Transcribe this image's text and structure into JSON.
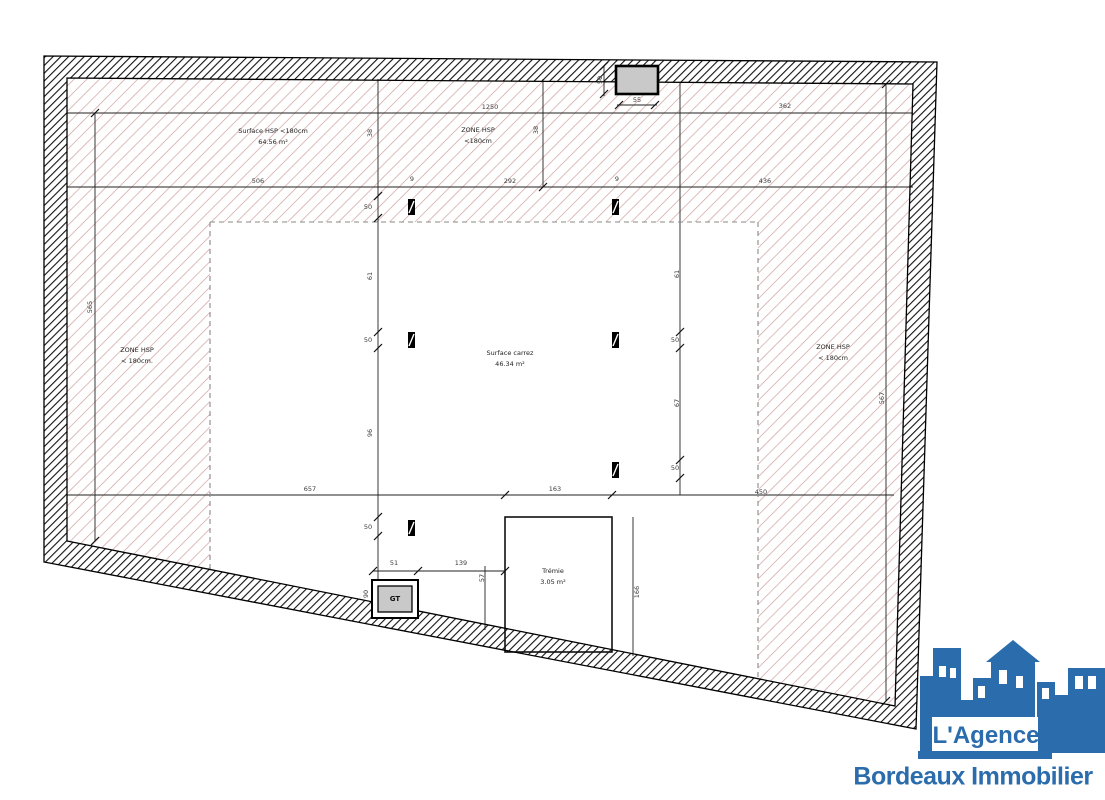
{
  "plan": {
    "labels": {
      "surface_hsp": {
        "line1": "Surface HSP <180cm",
        "line2": "64.56 m²"
      },
      "zone_top": {
        "line1": "ZONE HSP",
        "line2": "<180cm"
      },
      "zone_left": {
        "line1": "ZONE HSP",
        "line2": "< 180cm."
      },
      "zone_right": {
        "line1": "ZONE HSP",
        "line2": "< 180cm"
      },
      "surface_carrez": {
        "line1": "Surface carrez",
        "line2": "46.34 m²"
      },
      "tremie": {
        "line1": "Trémie",
        "line2": "3.05 m²"
      },
      "gt": "GT"
    },
    "dimensions": [
      {
        "value": "1250",
        "x": 490,
        "y": 107
      },
      {
        "value": "362",
        "x": 785,
        "y": 106
      },
      {
        "value": "55",
        "x": 637,
        "y": 100
      },
      {
        "value": "50",
        "x": 600,
        "y": 80,
        "rot": -90
      },
      {
        "value": "506",
        "x": 258,
        "y": 181
      },
      {
        "value": "292",
        "x": 510,
        "y": 181
      },
      {
        "value": "436",
        "x": 765,
        "y": 181
      },
      {
        "value": "9",
        "x": 412,
        "y": 179
      },
      {
        "value": "9",
        "x": 617,
        "y": 179
      },
      {
        "value": "38",
        "x": 370,
        "y": 133,
        "rot": -90
      },
      {
        "value": "38",
        "x": 536,
        "y": 130,
        "rot": -90
      },
      {
        "value": "50",
        "x": 368,
        "y": 207
      },
      {
        "value": "61",
        "x": 370,
        "y": 276,
        "rot": -90
      },
      {
        "value": "50",
        "x": 368,
        "y": 340
      },
      {
        "value": "96",
        "x": 370,
        "y": 433,
        "rot": -90
      },
      {
        "value": "50",
        "x": 368,
        "y": 527
      },
      {
        "value": "61",
        "x": 677,
        "y": 274,
        "rot": -90
      },
      {
        "value": "50",
        "x": 675,
        "y": 340
      },
      {
        "value": "67",
        "x": 677,
        "y": 403,
        "rot": -90
      },
      {
        "value": "50",
        "x": 675,
        "y": 468
      },
      {
        "value": "565",
        "x": 90,
        "y": 307,
        "rot": -90
      },
      {
        "value": "567",
        "x": 882,
        "y": 398,
        "rot": -90
      },
      {
        "value": "657",
        "x": 310,
        "y": 489
      },
      {
        "value": "163",
        "x": 555,
        "y": 489
      },
      {
        "value": "450",
        "x": 761,
        "y": 492
      },
      {
        "value": "51",
        "x": 394,
        "y": 563
      },
      {
        "value": "139",
        "x": 461,
        "y": 563
      },
      {
        "value": "90",
        "x": 366,
        "y": 594,
        "rot": -90
      },
      {
        "value": "57",
        "x": 482,
        "y": 578,
        "rot": -90
      },
      {
        "value": "166",
        "x": 637,
        "y": 592,
        "rot": -90
      }
    ],
    "colors": {
      "hatch_pink": "#cfa0a0",
      "wall_hatch": "#111111",
      "line": "#222222",
      "skylight_fill": "#c9c9c9"
    }
  },
  "logo": {
    "agency_line": "L'Agence",
    "city_line": "Bordeaux Immobilier",
    "color": "#2b6cac"
  }
}
